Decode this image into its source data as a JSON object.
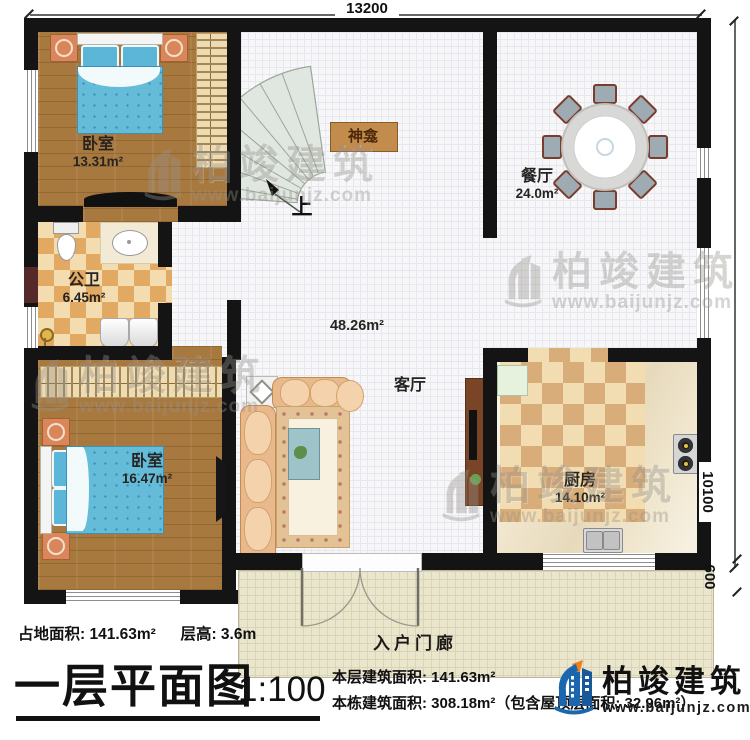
{
  "plan": {
    "dimensions": {
      "top": "13200",
      "right": "10100",
      "porch": "600"
    },
    "rooms": [
      {
        "name": "卧室",
        "area": "13.31m²"
      },
      {
        "name": "公卫",
        "area": "6.45m²"
      },
      {
        "name": "卧室",
        "area": "16.47m²"
      },
      {
        "name": "餐厅",
        "area": "24.0m²"
      },
      {
        "name": "客厅",
        "area": "48.26m²"
      },
      {
        "name": "厨房",
        "area": "14.10m²"
      },
      {
        "name": "入户门廊",
        "area": ""
      },
      {
        "name": "神龛",
        "area": ""
      }
    ],
    "stair_up_label": "上"
  },
  "annotations": {
    "land_area": "占地面积: 141.63m²",
    "floor_height": "层高: 3.6m",
    "title": "一层平面图",
    "scale": "1:100",
    "floor_area": "本层建筑面积: 141.63m²",
    "building_area": "本栋建筑面积: 308.18m²（包含屋顶层面积: 32.96m²）"
  },
  "brand": {
    "name": "柏竣建筑",
    "url": "www.baijunjz.com"
  },
  "watermark": {
    "name": "柏竣建筑",
    "url": "www.baijunjz.com"
  },
  "colors": {
    "wall": "#141414",
    "wood": "#a8793f",
    "bed_blue": "#64bcd9",
    "brand_blue": "#1a67b0",
    "brand_orange": "#f08019"
  }
}
